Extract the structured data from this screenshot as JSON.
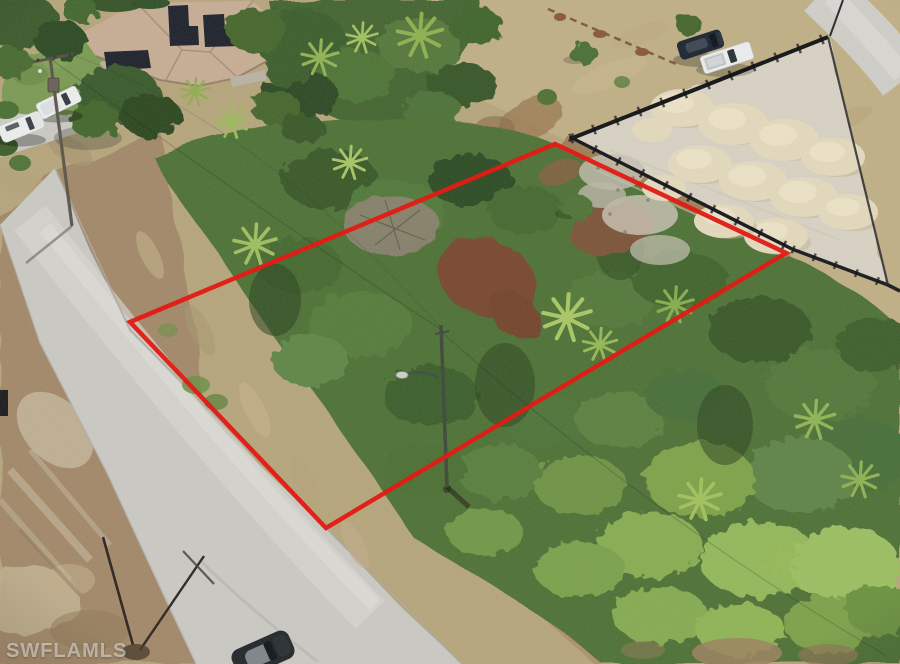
{
  "image": {
    "width": 900,
    "height": 664,
    "kind": "aerial drone photo of a vacant residential lot (real-estate listing)"
  },
  "watermark": {
    "text": "SWFLAMLS"
  },
  "boundary": {
    "label": "vacant-lot-boundary",
    "color": "#e3150f",
    "stroke_width": 4.5,
    "points": "130,322 555,144 786,253 326,528"
  },
  "palette": {
    "dry_grass": "#b6a67d",
    "dry_grass_light": "#c0b087",
    "scrub_dirt": "#a3896a",
    "road": "#cac9c4",
    "lawn": "#7c9b55",
    "house_roof": "#c7ae95",
    "solar_panel": "#20242e",
    "vegetation_band": "#456631",
    "vegetation_main": "#4f7338",
    "sand_lot": "#d8d2c4",
    "sand_pile": "#e3d9bd",
    "silt_fence": "#17181c",
    "dirt_strip": "#9b7b54",
    "white_vehicle": "#eceeee",
    "black_vehicle": "#1d2733",
    "bottom_car": "#23282c",
    "pole": "#5d564b"
  },
  "features": [
    "vacant lot outlined in red",
    "residential street",
    "house with rooftop solar panels",
    "cleared lot with sand piles and silt fence",
    "black suv and white pickup parked on dry grass",
    "white pickup and white suv parked on side street",
    "street light pole inside lot",
    "utility pole with crossarm",
    "palmetto vegetation",
    "car at bottom edge of frame"
  ]
}
